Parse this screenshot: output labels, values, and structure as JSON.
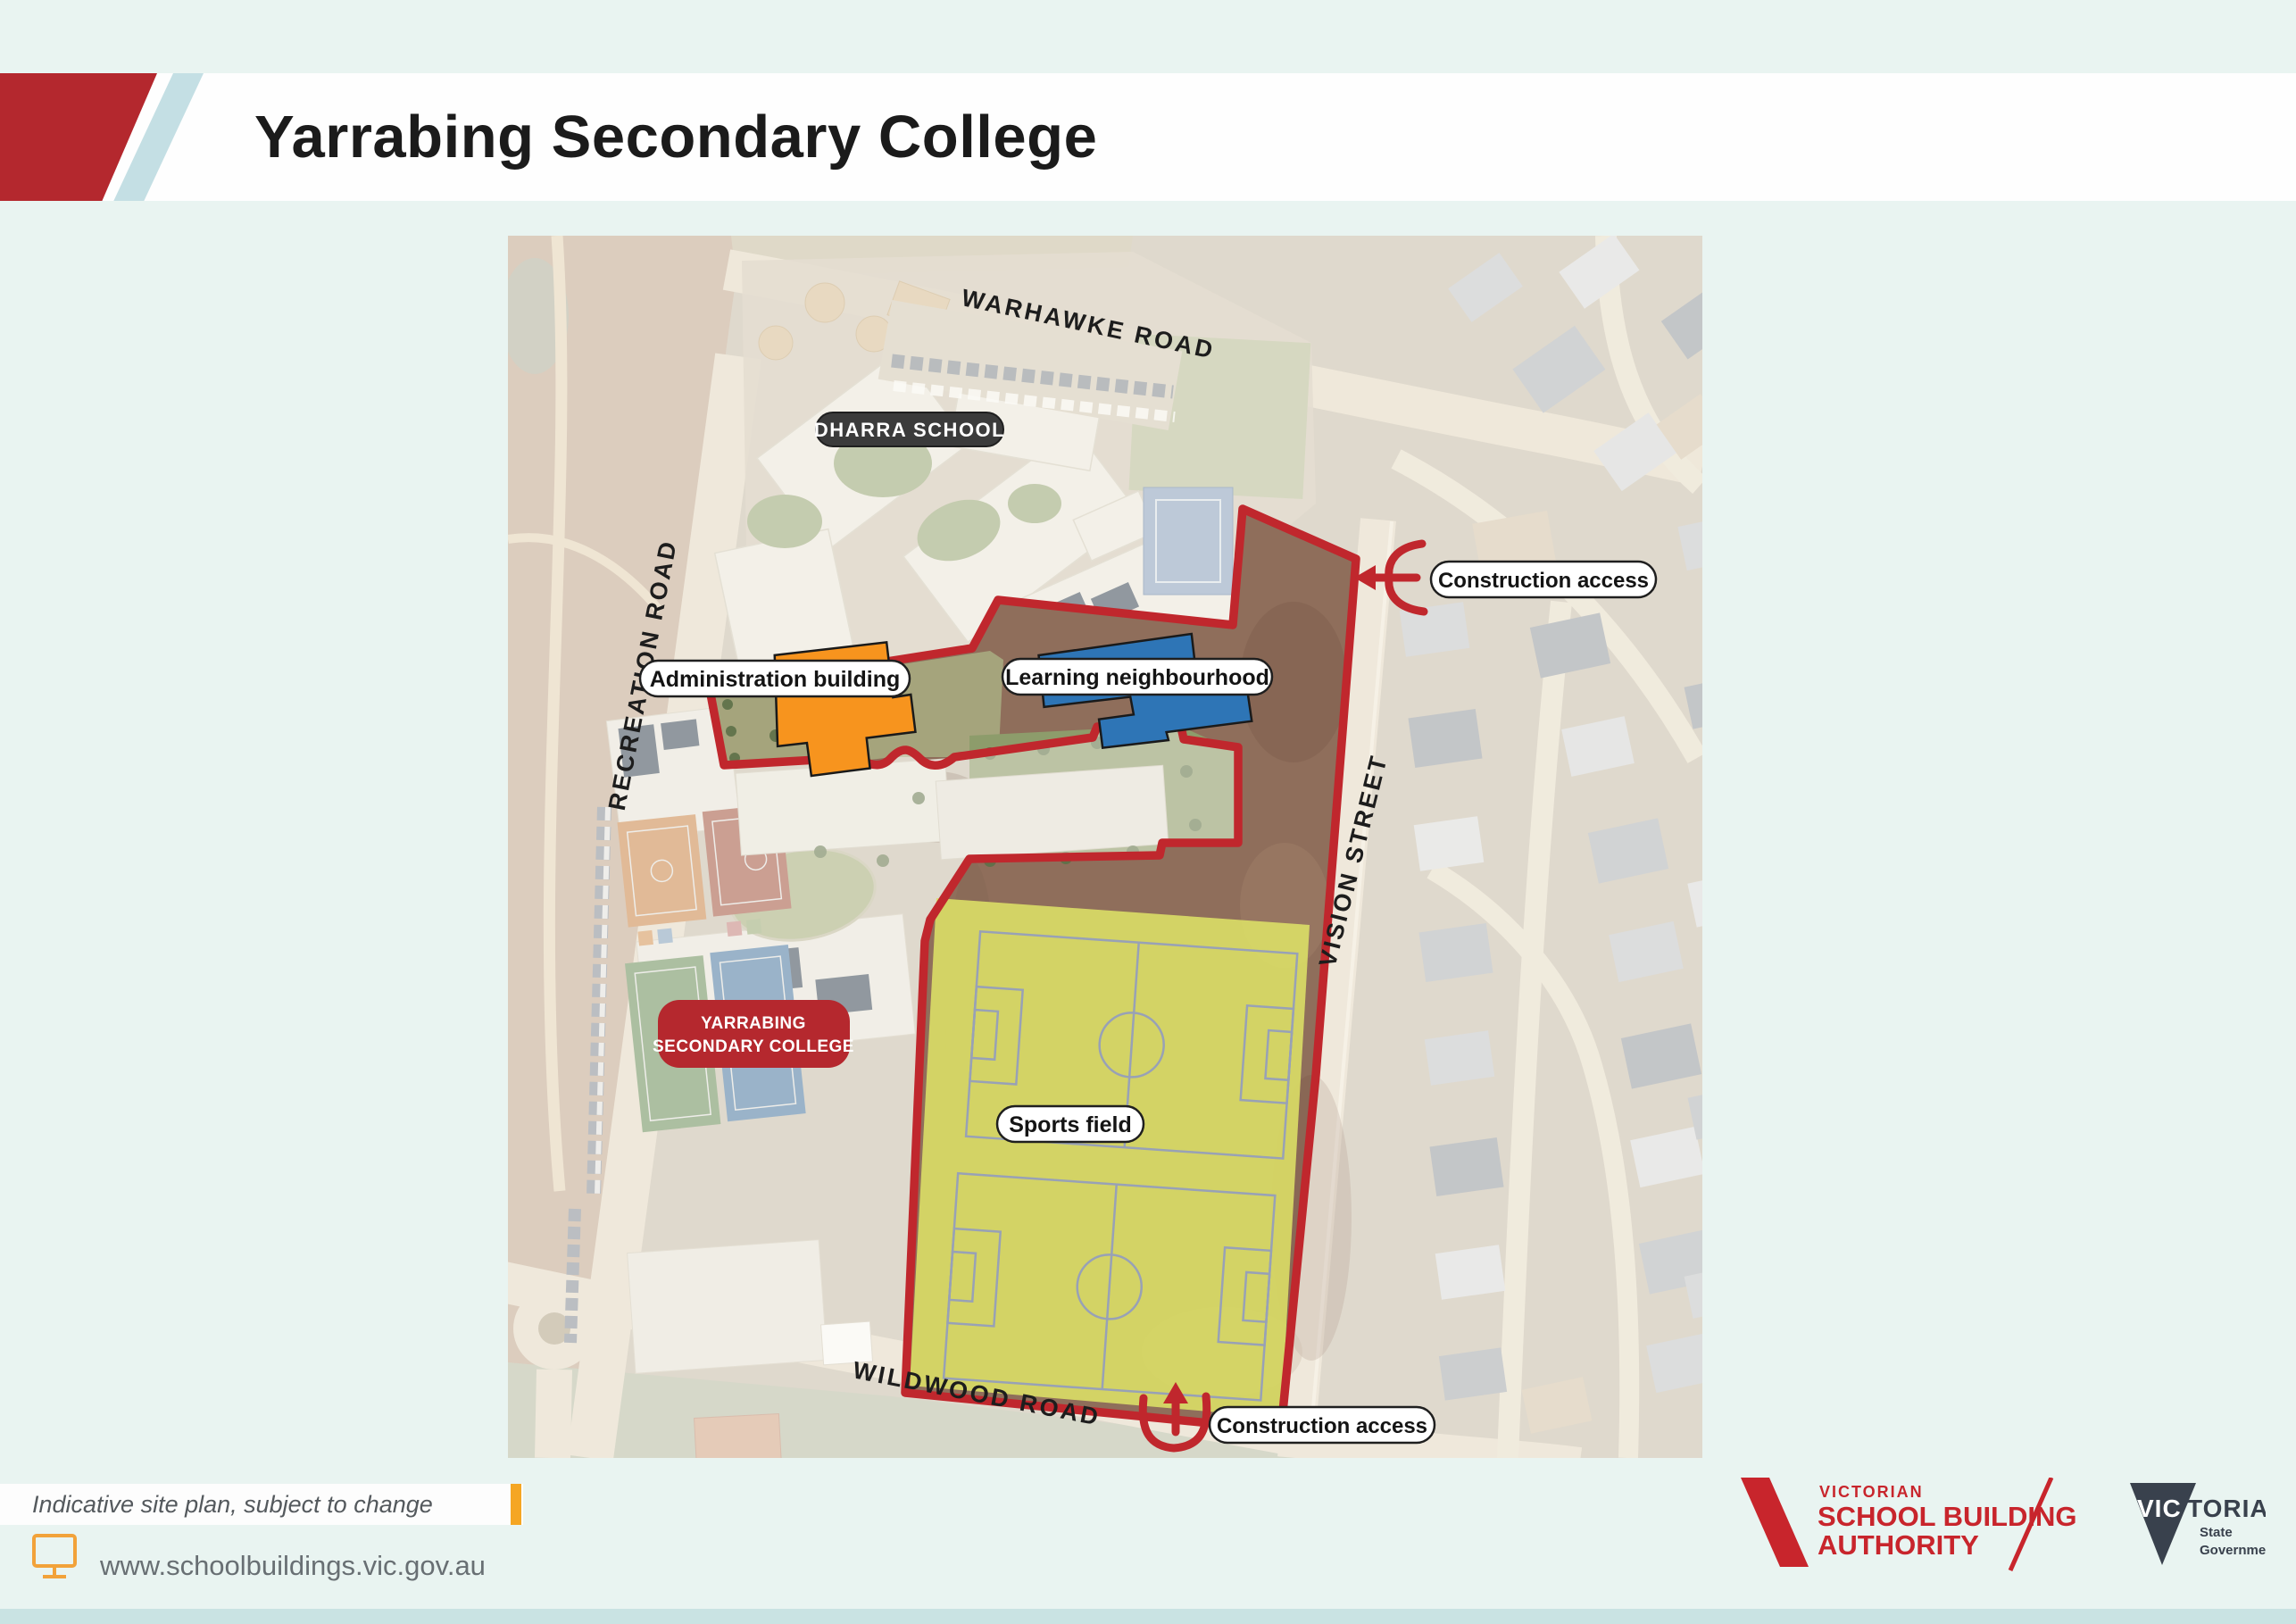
{
  "header": {
    "title": "Yarrabing Secondary College"
  },
  "map": {
    "road_labels": {
      "warhawke": "WARHAWKE ROAD",
      "recreation": "RECREATION ROAD",
      "vision": "VISION STREET",
      "wildwood": "WILDWOOD ROAD"
    },
    "place_labels": {
      "dharra_school": "DHARRA SCHOOL",
      "administration_building": "Administration building",
      "learning_neighbourhood": "Learning neighbourhood",
      "college_line1": "YARRABING",
      "college_line2": "SECONDARY COLLEGE",
      "sports_field": "Sports field",
      "construction_access_north": "Construction access",
      "construction_access_south": "Construction access"
    },
    "legend_colors": {
      "site_boundary": "#c0272d",
      "administration_building": "#f7941e",
      "learning_neighbourhood": "#2e75b6",
      "sports_field": "#dde167",
      "college_badge": "#b5282e",
      "dharra_badge": "#3b3b3b"
    }
  },
  "footer": {
    "disclaimer": "Indicative site plan, subject to change",
    "website": "www.schoolbuildings.vic.gov.au",
    "vsba_logo": {
      "line1": "VICTORIAN",
      "line2": "SCHOOL BUILDING",
      "line3": "AUTHORITY"
    },
    "victoria_logo": {
      "word_white": "VIC",
      "word_dark": "TORIA",
      "sub_line1": "State",
      "sub_line2": "Government"
    }
  }
}
